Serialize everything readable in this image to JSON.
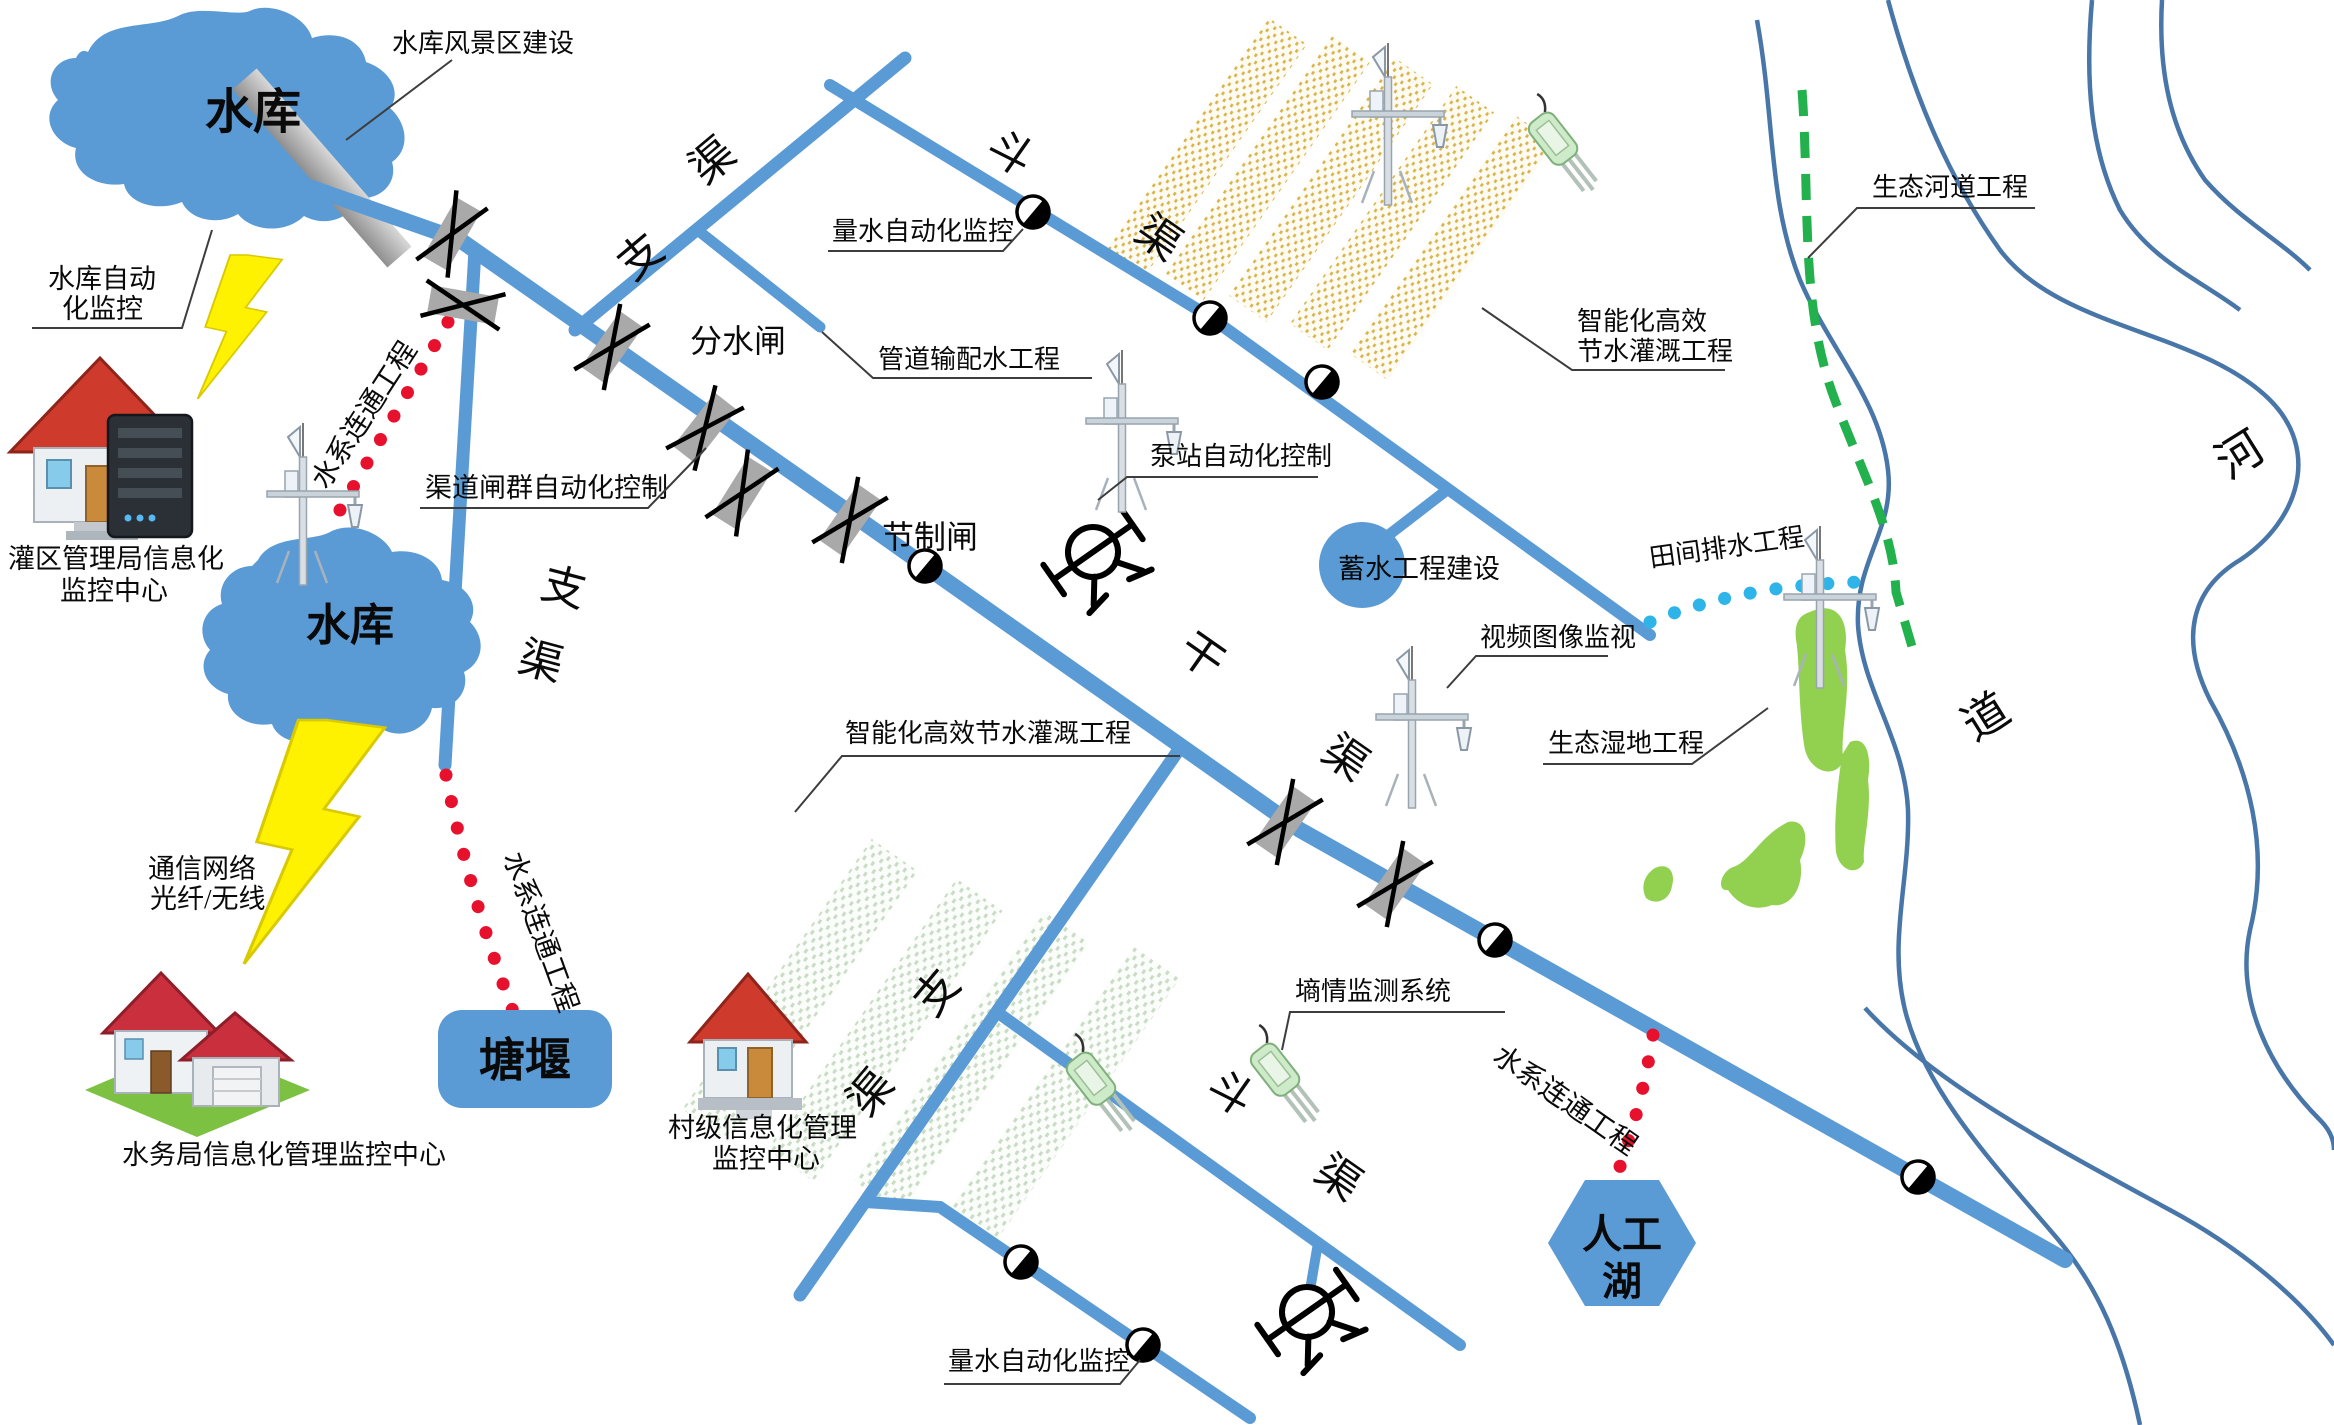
{
  "colors": {
    "canal_blue": "#5B9BD5",
    "river_bank": "#4876A8",
    "dot_red": "#E8112D",
    "dot_cyan": "#2FB4E9",
    "dash_green": "#22B14C",
    "wetland_green": "#92D050",
    "lightning_yellow": "#FFF200",
    "gate_gray": "#A9A9A9",
    "roof_red": "#CE3B2C",
    "field_yellow": "#D9B44A",
    "field_green": "#BFD5BA"
  },
  "icons": {
    "gate": "sluice-gate-x",
    "flowmeter": "half-black-circle-meter",
    "pump": "pump-station-circle",
    "tower": "telemetry-monitoring-tower",
    "sensor": "soil-moisture-probe",
    "lightning": "wireless-link-bolt",
    "dam": "reservoir-dam-bar"
  },
  "nodes": {
    "reservoir1": "水库",
    "reservoir2": "水库",
    "pond_weir": "塘堰",
    "artificial_lake": [
      "人工",
      "湖"
    ],
    "storage_project": "蓄水工程建设"
  },
  "centers": {
    "bureau": [
      "灌区管理局信息化",
      "监控中心"
    ],
    "village": [
      "村级信息化管理",
      "监控中心"
    ],
    "water_affairs": "水务局信息化管理监控中心"
  },
  "links": {
    "network": [
      "通信网络",
      "光纤/无线"
    ],
    "connect": "水系连通工程",
    "field_drain": "田间排水工程"
  },
  "annotations": {
    "scenic": "水库风景区建设",
    "res_auto": [
      "水库自动",
      "化监控"
    ],
    "gate_group": "渠道闸群自动化控制",
    "diversion_gate": "分水闸",
    "control_gate": "节制闸",
    "measure": "量水自动化监控",
    "pipeline": "管道输配水工程",
    "pump_auto": "泵站自动化控制",
    "smart_irrigation": [
      "智能化高效",
      "节水灌溉工程"
    ],
    "smart_irrigation_full": "智能化高效节水灌溉工程",
    "eco_river": "生态河道工程",
    "video": "视频图像监视",
    "eco_wetland": "生态湿地工程",
    "moisture": "墒情监测系统"
  },
  "canal_chars": {
    "main": [
      "干",
      "渠"
    ],
    "branch": [
      "支",
      "渠"
    ],
    "field": [
      "斗",
      "渠"
    ]
  },
  "river_chars": [
    "河",
    "道"
  ]
}
